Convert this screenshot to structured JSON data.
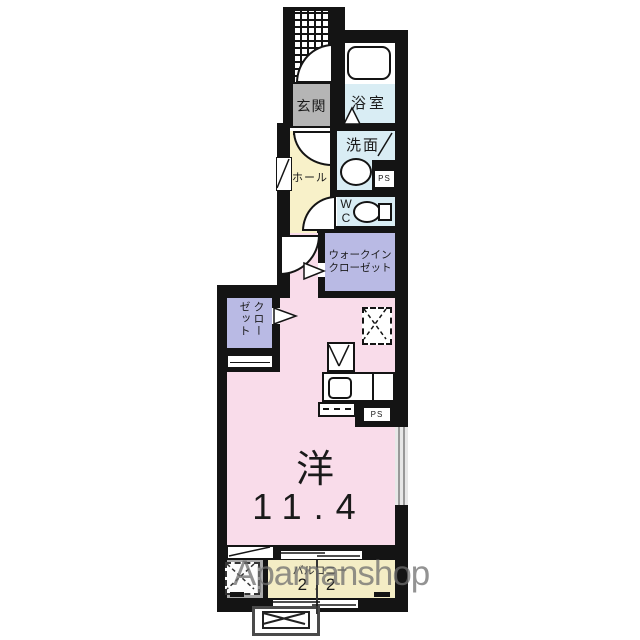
{
  "plan": {
    "labels": {
      "genkan": "玄関",
      "bath": "浴室",
      "washroom": "洗面",
      "wc_w": "W",
      "wc_c": "C",
      "hall": "ホール",
      "wic_line1": "ウォークイン",
      "wic_line2": "クローゼット",
      "closet": "クローゼット",
      "room_type": "洋",
      "room_size": "11.4",
      "balcony": "バルコニー",
      "balcony_size": "2.2",
      "ps_upper": "PS",
      "ps_lower": "PS"
    },
    "watermark": "Apamanshop",
    "colors": {
      "wall": "#141414",
      "main_room_pink": "#f9dcea",
      "hall_yellow": "#f8f1c9",
      "wet_area_blue": "#d9edf4",
      "closet_lavender": "#b9bae4",
      "genkan_gray": "#b5b5b5",
      "balcony_cream": "#f4edc5",
      "outdoor_gray": "#a9a9a9",
      "watermark_gray": "#6f6f6f"
    }
  }
}
